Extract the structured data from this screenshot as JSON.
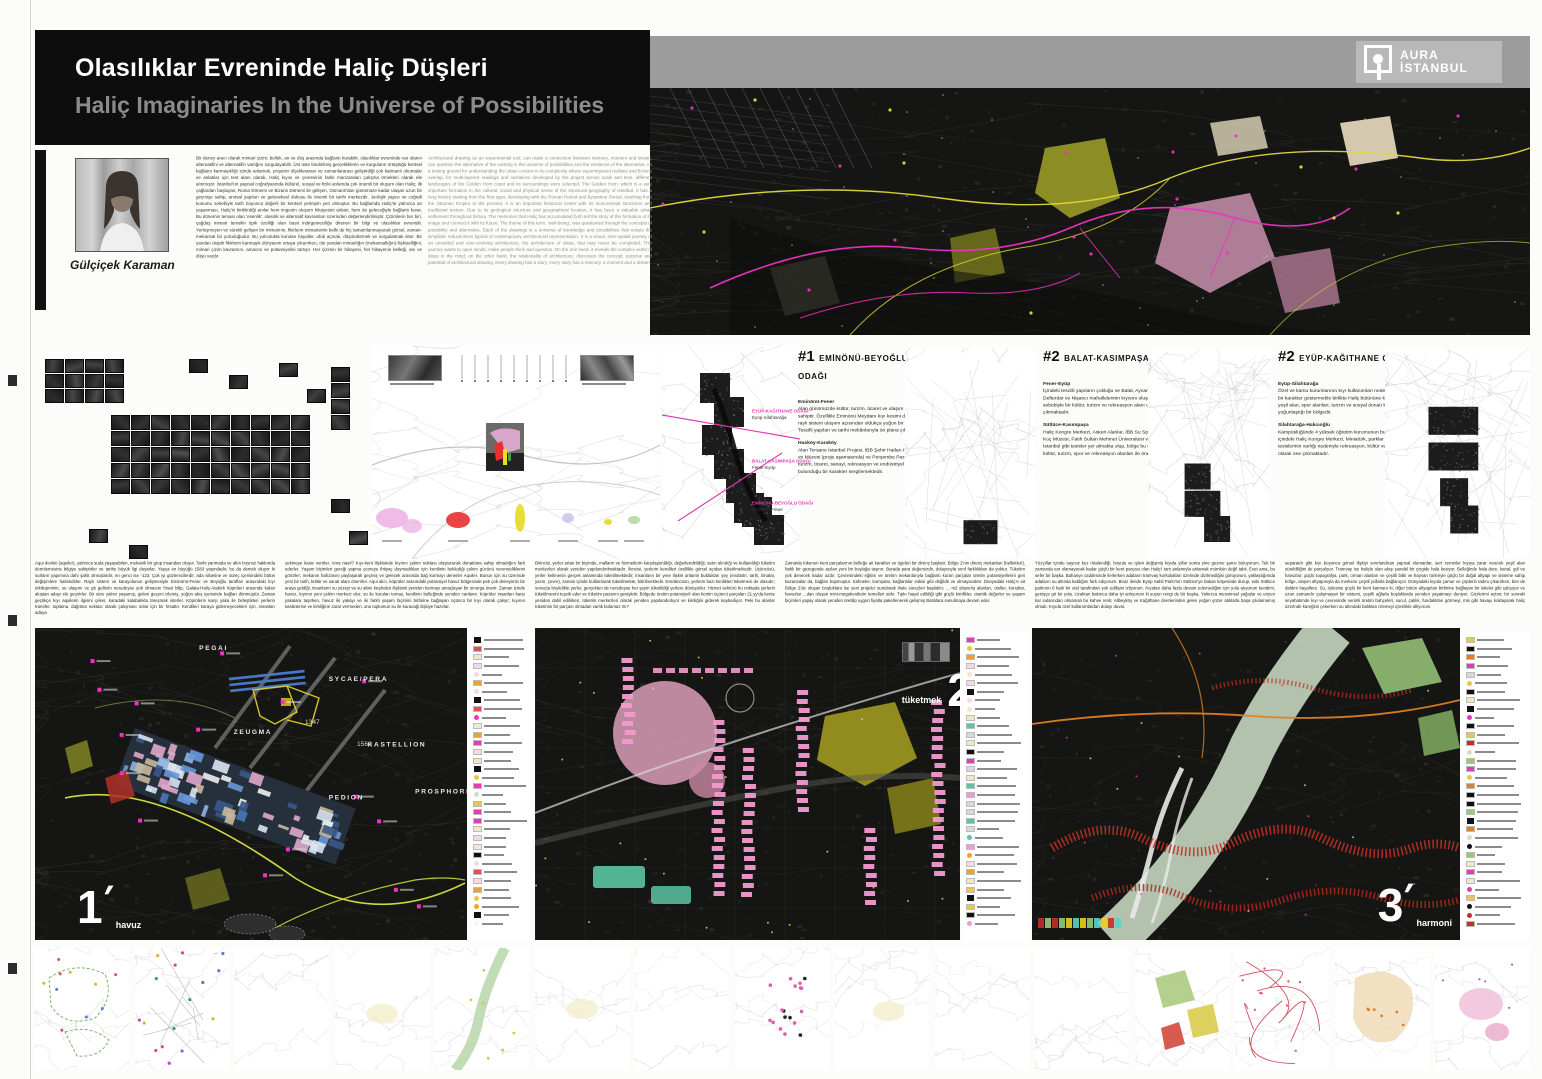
{
  "header": {
    "title_tr": "Olasılıklar Evreninde Haliç Düşleri",
    "title_en": "Haliç Imaginaries In the Universe of Possibilities"
  },
  "logo": {
    "line1": "AURA",
    "line2": "İSTANBUL"
  },
  "author": {
    "name": "Gülçiçek Karaman"
  },
  "intro": {
    "tr": "Bir deney aracı olarak mimari çizim; bellek, an ve düş arasında bağlantı kurabilir, olasılıklar evreninde var olanın alternatifini ve alternatifin varlığını sorgulayabilir. Üst üste bindirilmiş gerçekliklerin ve kurguların örtüştüğü kentsel bağlamı karmaşıklığı içinde anlamak, projenin ölçeklerarası ve zamanlararası geliştirdiği çok katmanlı okumalar ve anlatılar için test alanı olarak, Haliç kıyısı ve çevresinin farklı manzaraları çalışma örnekleri olarak ele alınmıştır. İstanbul'un yapısal coğrafyasında kültürel, sosyal ve fiziki anlamda çok önemli bir oluşum olan Haliç; ilk çağlardan başlayan, Roma Dönemi ve Bizans Dönemi ile gelişen, Osmanlı'dan günümüze kadar ulaşan uzun bir geçmişe sahip, anıtsal yapıları ve geleneksel dokusu ile önemli bir tarihi merkezdir. Jeolojik yapısı ve coğrafi konumu sebebiyle tarih boyunca değerli bir kentsel yerleşim yeri olmuştur. Bu bağlamda Haliç'te yalnızca an yaşanması, Haliç'in biriktirdiği anılar hem imgenin oluşum hikayesini anlatır, hem de geleceğiyle bağlantı kurar. Bu dönemin teması olan 'esenlik', olasılık ve alternatif kavramları üzerinden değerlendirilmiştir. Çizimlerin her biri, çağdaş mimari temsilin tipik özelliği olan basit indirgemeciliğe direnen bir bilgi ve olasılıklar evrenidir. Yerleşmeyen ve sürekli gelişen bir mimarinin, fikirlerin mimarisinin belki de hiç tamamlanmayacak görsel, zaman-mekansal bir yolculuğudur. Bu yolculukta kurulan hayaller, ufuk açmak, düşündürmek ve sorgulatmak ister. Bir yandan ütopik fikirlerin karmaşık dünyasını ortaya çıkarırken, öte yandan mimarlığın (mekansallığın) ilişkiselliğini, mimari çizim kavramını, amacını ve potansiyelini tartışır. Her çizimin bir hikayesi, her hikayenin belleği, anı ve düşü vardır.",
    "en": "Architectural drawing as an experimental tool, can make a connection between memory, moment and dream, can question the alternative of the existing in the universe of possibilities and the existence of the alternative. As a testing ground for understanding the urban context in its complexity where superimposed realities and fictions overlap, for multi-layered readings and narratives developed by the project across scale and time, different landscapes of the Golden Horn coast and its surroundings were selected. The Golden Horn, which is a very important formation in the cultural, social and physical sense of the structural geography of Istanbul. It has a long history starting from the first ages, developing with the Roman Period and Byzantine Period, reaching from the Ottoman Empire to the present. It is an important historical center with its monumental structures and traditional texture. Due to its geological structure and geographical location, it has been a valuable urban settlement throughout history. The memories that Haliç has accumulated both tell the story of the formation of its image and connect it with its future. The theme of this term, 'well-being', was questioned through the concepts of possibility and alternative. Each of the drawings is a universe of knowledge and possibilities that resists the simplistic reductionism typical of contemporary architectural representation. It is a visual, time-spatial journey of an unsettled and ever-evolving architecture, the architecture of ideas, that may never be completed. This journey wants to open minds, make people think and question. On the one hand, it reveals the complex world of ideas in the mind; on the other hand, the relationality of architecture; discusses the concept, purpose and potential of architectural drawing. Every drawing has a story, every story has a memory, a moment and a dream."
  },
  "focus_sections": [
    {
      "num": "#1",
      "title": "EMİNÖNÜ-BEYOĞLU ODAĞI",
      "blocks": [
        {
          "heading": "Eminönü-Fener",
          "body": "Alan günümüzde kültür, turizm, ticaret ve ulaşım işlevlerine sahiptir. Özellikle Eminönü Meydanı kıyı kesimi deniz, kara ve raylı sistem ulaşımı açısından oldukça yoğun bir bölgedir. Tescilli yapıları ve tarihi mekânlarıyla ön plana çıkmaktadır."
        },
        {
          "heading": "Hasköy-Karaköy",
          "body": "Alan Tersane İstanbul Projesi, İBB Şehir Hatları Haliç Tersanesi ve Müzesi (proje aşamasında) ve Perşembe Pazarı bölgesiyle turizm, ticaret, sanayi, rekreasyon ve endüstriyel mirasın iç içe bulunduğu bir karakter sergilemektedir."
        }
      ]
    },
    {
      "num": "#2",
      "title": "BALAT-KASIMPAŞA ODAĞI",
      "blocks": [
        {
          "heading": "Fener-Eyüp",
          "body": "İçindeki tescilli yapıların çokluğu ve Balat, Ayvansaray, Defterdar ve Nişancı mahallelerinin kıyısını oluşturması sebebiyle bir kültür, turizm ve rekreasyon alanı olarak öne çıkmaktadır."
        },
        {
          "heading": "Sütlüce-Kasımpaşa",
          "body": "Haliç Kongre Merkezi, Askeri Alanlar, İBB Su Sporları Merkezi, Koç Müzesi, Fatih Sultan Mehmet Üniversitesi ve Tersane İstanbul gibi tesisler yer almakta olup, bölge bu özellikleri ile kültür, turizm, spor ve rekreasyon alanları ile öne çıkmaktadır."
        }
      ]
    },
    {
      "num": "#2",
      "title": "EYÜP-KAĞITHANE ODAĞI",
      "blocks": [
        {
          "heading": "Eyüp-Silahtarağa",
          "body": "Özel ve kamu kurumlarının kıyı kullanımları nedeniyle parçacıl bir karakter göstermekle birlikte Haliç bütününe kıyasla açık-yeşil alan, spor alanları, turizm ve sosyal donatı kullanımlarının yoğunlaştığı bir bölgedir."
        },
        {
          "heading": "Silahtarağa-Halıcıoğlu",
          "body": "Kampüslüğünde 4 yüksek öğretim kurumunun bulunduğu alan, içindeki Haliç Kongre Merkezi, Miniatürk, parklar ve spor tesislerinin varlığı nedeniyle rekreasyon, kültür ve spor alanı olarak öne çıkmaktadır."
        }
      ]
    }
  ],
  "mosaic_labels": [
    {
      "label": "EYÜP-KAĞITHANE ODAĞI",
      "sub": "Eyüp-Silahtarağa"
    },
    {
      "label": "BALAT-KASIMPAŞA ODAĞI",
      "sub": "Fener-Eyüp"
    },
    {
      "label": "EMİNÖNÜ-BEYOĞLU ODAĞI",
      "sub": "Eminönü-Fener"
    }
  ],
  "essay_columns": [
    "Aqui devleti (aquiler), yalnızca suda yaşayabilen, mekanik bir grup insandan oluşur. Tarihi yarımada ve altın boynuz hakkında derinlemesine bilgiye sahiptirler ve tarihe büyük ilgi duyarlar. Yaşça en büyüğü 1583 yaşındadır, bu da demek oluyor ki surların yapımına dahi şahit olmuşlardır, en genci ise -123. Çok iyi gözlemcilerdir; ada silüetine ve süreç içerisindeki bütün değişimlere hakimdirler. Raylı sistem ve karayolunun gelişmesiyle Eminönü-Fener ve Beyoğlu tarafları arasındaki kıyı etkileşiminin, su ulaşımı ve git gellerin neredeyse yok olmasını fırsat bilip, Galata-Haliç-Atatürk köprüleri arasında kalan akıştan adayı ele geçirirler. Bir süre yalnız yaşamış, geleni geçeni izlemiş, yoğun akış içerisinde bağları dönmüştür. Zaman geçtikçe kıyı aquilerin ilgisini çeker, karadaki kalabalıkla tanışmak isterler. Köprülerin karşı yaka ile birleştikleri yerlerin transfer, toplama, dağıtma noktası olarak çalışması onlar için bir fırsattır. Kendileri karaya gidemeyecekleri için, insanları adaya",
    "çekmeye karar verirler. Ama nasıl? Kıyı-kent ilişkisinde kıyının çekim noktası oluşturacak donatılara sahip olmadığını fark ederler. Yaşam biçimleri gereği yapma çevreye ihtiyaç duymadıkları için kentlinin beklediği çekim gücünü veremediklerini görürler; mekanın hafızasını paylaşarak geçmiş ve gelecek arasında bağ kurmayı denerler Aquiler. Bunun için su üzerinde yeni bir tarih, kültür ve sanat alanı önerirler. Aqui alıcı, köprüler arasındaki potansiyel havuz bölgesinde pek çok deneyimin bir araya geldiği, insanların su yüzeyi ve su altını keşfeden ilişkisini yeniden kurmayı amaçlayan bir omurga önerir. Zaman içinde havuz, kıyının yeni çekim merkezi olur; su ile kurulan temas, kentlinin belleğinde yeniden canlanır. Köprüler insanları karşı yakalara taşırken, havuz iki yakayı ve iki farklı yaşam biçimini birbirine bağlayan üçüncü bir kıyı olarak çalışır; kıyının karakterine ve kimliğine zarar vermeden, onu toplumun su ile kuracağı ilişkiye hazırlar.",
    "Birincisi, yerler artan bir biçimde, malların ve hizmetlerin karşılaştırıldığı, değerlendirildiği, satın alındığı ve kullanıldığı tüketim merkezleri olarak yeniden yapılandırılmaktadır. İkincisi, yerlerin kendileri özellikle görsel açıdan tüketilmektedir. Üçüncüsü, yerler kelimenin gerçek anlamında tüketilmektedir; insanların bir yere ilişkin anlamlı buldukları şey (endüstri, tarih, binalar, yazın, çevre), zaman içinde kullanılarak tüketilmekte, bitirilmektedir. Dördüncüsü, yerlerin bazı kimlikleri tüketmesi de olasıdır; sonuçta böylelikle yerler, gerçekten de neredeyse her şeyin tüketildiği yerlere dönüşürler. Hizmet sektörü bu noktada yerlerin tüketilmesini teşvik eder ve tüketim pazarını genişletir. Bölgede üretim potansiyeli olan kentin üçüncü parçaları 21.yy'da kente yeniden dahil edilirken, tüketim merkezleri olarak yeniden yapılandırılıyor ve kimliğini giderek kaybediyor. Peki bu alanlar tüketimin bir parçası olmadan varlık bulamaz mı?",
    "Zamanla tükenen kent parçalarının belleğe ait karakter ve ögeleri bir direnç başlatır. Bölge 2'nin direnç mekanları (bellekleri), farklı bir gezegende açılan yeni bir boşluğa taşınır. Burada para değersizdir, dolayısıyla sınıf farklılıkları da yoktur. Tüketim yok denecek kadar azdır. Çevresindeki eğitim ve üretim mekanlarıyla bağlantı kuran parçalar üretim potansiyellerini geri kazansalar da, bağları kopmuştur. Sahneler, komşular, bağlantılar eskisi gibi değildir ve olmayacaktır. Dünyadaki Haliç'e ait Bölge 2'de oluşan boşluklara ise yeni projeler sunularak ihale süreçleri başlatılır; ... m2 alışveriş alanları, oteller, konutlar, havuzlar ...dan oluşan mini-megakentlerin temelleri atılır. Tıpkı hayal edildiği gibi güçlü kimlikler, otantik değerler ve yaşam biçimleri yapay olarak yeniden üretilip uygun fiyatla paketlenerek gelişmiş Batılılara sunulmaya devam eder.",
    "Yüzyıllar içinde sayısız kez rötalendiği, boyutu ve işlevi değişmiş kıyıda yıllar sonra yine gezme şansı buluyorum. Tek bir zamanda var olamayacak kadar güçlü bir kent parçası olan Haliç'i tam anlamıyla anlamak mümkün değil tabii. Evet ama, bu sefer bir başka. Bahariye caddesinde ilerlerken adaların tramvay korkulukları üzerinde dizilmediğini görüyorum, yaklaştığımda adaların su altında kaldığını fark ediyorum. Biraz ileride Eyüp Sahil Parkı'nın Sütlüce'ye bakan köşesinde durup, eski Sütlüce parkının 8 katlı bir otel tarafından yok edilişini izliyorum. Kıyıdan daha fazla devam edemediğim için yola atıyorum kendimi, genişçe gri bir yola. Uzaktan bakınca daha iyi anlıyorum ki suyun rengi de bir başka. Yalnızca mevsimsel yağışlar ve eriyen kar sularından olmamalı bu kahve renk; Alibeyköy ve Kağıthane derelerinden gelen yoğun yüzer atıklarla başa çıkılamamış olmalı. Kıyıda özel kullanımlardan dolayı duvar,",
    "separatör gibi kıyı boyunca görsel ilişkiyi sınırlandıran yapısal elemanlar, sert zeminler kıyıya zarar vererek yeşil alan sürekliliğini de parçalıyor. Tramvay ise haliçle olan akışı paralel bir çizgide hala kesiyor. Belleğinde hala dere, kanal, göl ve havuzlar; güçlü topografya, park, orman alanları ve çeşitli bitki ve hayvan türleriyle güçlü bir doğal altyapı ve sisteme sahip bölge, ulaşım altyapısıyla da merkeze çeşitli yollarla bağlanıyor. Dünyadaki kıyıda çamur ve çöplerin tadını çıkarırken, ben de daldım hayallere. Su, öylesine güçlü bir kent katmanı ki, diğer bütün altyapıları birbirine bağlayan bir iskelet gibi çalışıyor ve uzun zamandır çalışmayan bir sistemi, çeşitli ağlarla boşluklarda yeniden yaşatmayı deniyor. Gözlerimi açtım; bir sonraki seyahatimde kıyı ve çevresinde verimli üretim bahçeleri, sucul, çalılık, fundalıkları görmeyi, mis gibi havayı koklayarak haliç üzerinde küreğimi çekerken su altındaki balıkları izlemeyi içtenlikle diliyorum."
  ],
  "maps": [
    {
      "number": "1",
      "caption": "havuz",
      "place_labels": [
        {
          "t": "PEGAI",
          "x": 38,
          "y": 7
        },
        {
          "t": "SYCAE/PERA",
          "x": 68,
          "y": 17
        },
        {
          "t": "ZEUGMA",
          "x": 46,
          "y": 34
        },
        {
          "t": "KASTELLION",
          "x": 77,
          "y": 38
        },
        {
          "t": "PEDION",
          "x": 68,
          "y": 55
        },
        {
          "t": "PROSPHORION",
          "x": 88,
          "y": 53
        }
      ],
      "years": [
        "1347",
        "1560"
      ],
      "legend_palette": [
        "#f2e6c8",
        "#f5d9e4",
        "#e8c84a",
        "#d8d8d8",
        "#e23bb4",
        "#111111",
        "#f0a030",
        "#efe9d8",
        "#f7f3ea",
        "#e05050"
      ]
    },
    {
      "number": "2",
      "caption": "tüketmek",
      "legend_palette": [
        "#f29ad2",
        "#e8c84a",
        "#a8a020",
        "#5cc4a4",
        "#f0a030",
        "#d8d8d8",
        "#111111",
        "#f5d9e4",
        "#e23bb4",
        "#f2e6c8"
      ]
    },
    {
      "number": "3",
      "caption": "harmoni",
      "legend_palette": [
        "#5ad2c8",
        "#9ac87a",
        "#c03028",
        "#e08020",
        "#e23bb4",
        "#111111",
        "#d8d8d8",
        "#f2e6c8",
        "#cfe0c8",
        "#e8c84a"
      ]
    }
  ],
  "accent_colors": {
    "magenta": "#e23bb4",
    "yellow": "#e0d83a",
    "pink": "#d49ab2",
    "teal": "#5cc4a4",
    "red": "#c03028"
  }
}
